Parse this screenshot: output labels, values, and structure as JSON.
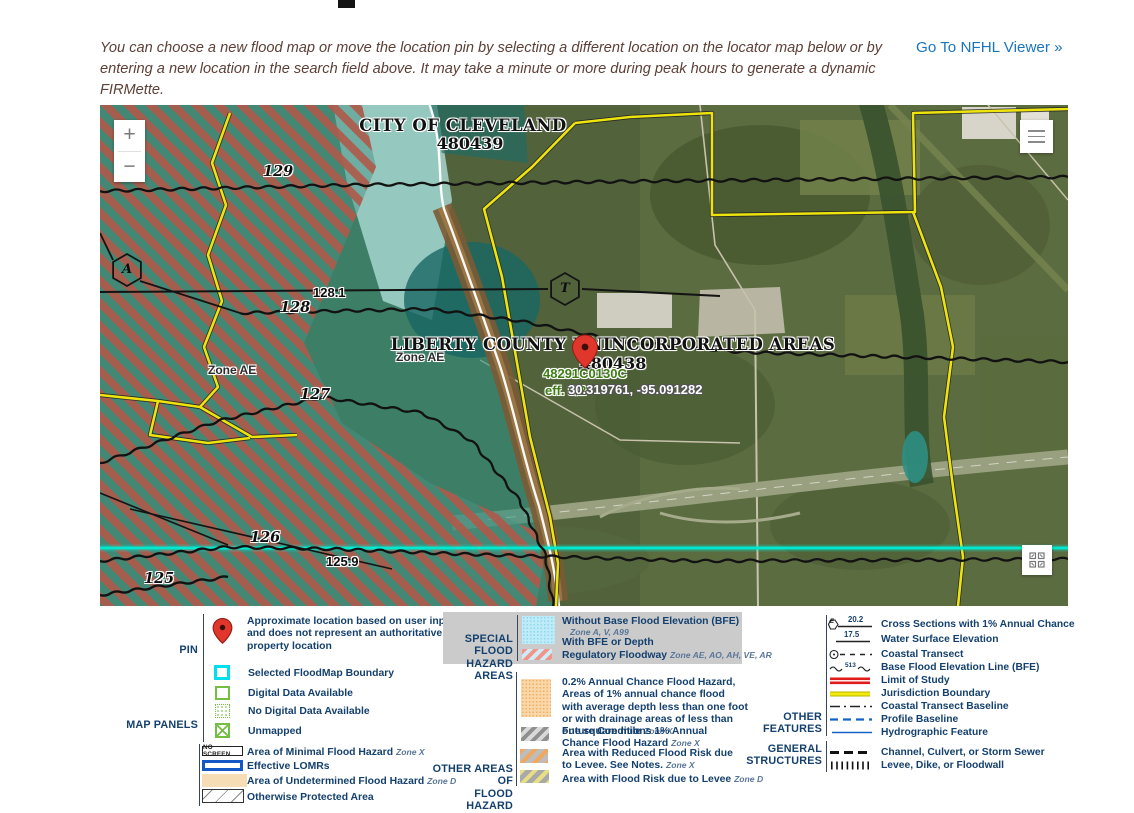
{
  "header": {
    "intro_text": "You can choose a new flood map or move the location pin by selecting a different location on the locator map below or by entering a new location in the search field above. It may take a minute or more during peak hours to generate a dynamic FIRMette.",
    "nfhl_link_label": "Go To NFHL Viewer »"
  },
  "map": {
    "zoom_in_label": "+",
    "zoom_out_label": "−",
    "city_label": "CITY OF CLEVELAND",
    "city_id": "480439",
    "county_label": "LIBERTY COUNTY UNINCORPORATED AREAS",
    "county_id": "480438",
    "firm_panel_id": "48291C0130C",
    "firm_effective": "eff. 5/2",
    "pin_coordinates": "30.319761, -95.091282",
    "zone_label_left": "Zone AE",
    "zone_label_right": "Zone AE",
    "hexagon_a": "A",
    "hexagon_t": "T",
    "bfe_labels": [
      {
        "text": "129"
      },
      {
        "text": "128"
      },
      {
        "text": "127"
      },
      {
        "text": "126"
      },
      {
        "text": "125"
      }
    ],
    "cross_section_labels": [
      {
        "text": "128.1"
      },
      {
        "text": "125.9"
      }
    ],
    "attribution": "USDA, USGS The National Map: Orthoimagery. Data refreshed June, 2024.",
    "powered_by": "Powered by Esri"
  },
  "legend": {
    "pin": {
      "label": "PIN",
      "description": "Approximate location based on user input and does not represent an authoritative property location"
    },
    "map_panels": {
      "label": "MAP PANELS",
      "items": [
        "Selected FloodMap Boundary",
        "Digital Data Available",
        "No Digital Data Available",
        "Unmapped"
      ]
    },
    "areas": {
      "no_screen_label": "NO SCREEN",
      "items": [
        {
          "label": "Area of Minimal Flood Hazard",
          "zone": "Zone X"
        },
        {
          "label": "Effective LOMRs",
          "zone": ""
        },
        {
          "label": "Area of Undetermined Flood Hazard",
          "zone": "Zone D"
        },
        {
          "label": "Otherwise Protected Area",
          "zone": ""
        }
      ]
    },
    "sfha": {
      "label_line1": "SPECIAL FLOOD",
      "label_line2": "HAZARD AREAS",
      "without_bfe": "Without Base Flood Elevation (BFE)",
      "without_bfe_zone": "Zone A, V, A99",
      "with_bfe": "With BFE or Depth",
      "floodway": "Regulatory Floodway",
      "floodway_zone": "Zone AE, AO, AH, VE, AR"
    },
    "other_areas": {
      "label_line1": "OTHER AREAS OF",
      "label_line2": "FLOOD HAZARD",
      "items": [
        {
          "label": "0.2% Annual Chance Flood Hazard, Areas of 1% annual chance flood with average depth less than one foot or with drainage areas of less than one square mile",
          "zone": "Zone X"
        },
        {
          "label": "Future Conditions 1% Annual Chance Flood Hazard",
          "zone": "Zone X"
        },
        {
          "label": "Area with Reduced Flood Risk due to Levee. See Notes.",
          "zone": "Zone X"
        },
        {
          "label": "Area with Flood Risk due to Levee",
          "zone": "Zone D"
        }
      ]
    },
    "features": {
      "other_label_line1": "OTHER",
      "other_label_line2": "FEATURES",
      "general_label_line1": "GENERAL",
      "general_label_line2": "STRUCTURES",
      "hexagon_letter": "E",
      "cross_section_value": "20.2",
      "water_surface_value": "17.5",
      "bfe_line_value": "513",
      "items": [
        {
          "label": "Cross Sections with 1% Annual Chance"
        },
        {
          "label": "Water Surface Elevation"
        },
        {
          "label": "Coastal Transect"
        },
        {
          "label": "Base Flood Elevation Line (BFE)"
        },
        {
          "label": "Limit of Study"
        },
        {
          "label": "Jurisdiction Boundary"
        },
        {
          "label": "Coastal Transect Baseline"
        },
        {
          "label": "Profile Baseline"
        },
        {
          "label": "Hydrographic Feature"
        },
        {
          "label": "Channel, Culvert, or Storm Sewer"
        },
        {
          "label": "Levee, Dike, or Floodwall"
        }
      ]
    }
  },
  "colors": {
    "link_blue": "#1b75bc",
    "legend_navy": "#14406e",
    "pin_red": "#e0362c",
    "jurisdiction_yellow": "#ede40e",
    "floodway_stripe_red": "#b05a4a",
    "sfha_cyan": "#b3e7f6",
    "transect_cyan": "#00e8cf",
    "limit_of_study_red": "#e01b1b",
    "firm_green": "#3e7d16"
  }
}
